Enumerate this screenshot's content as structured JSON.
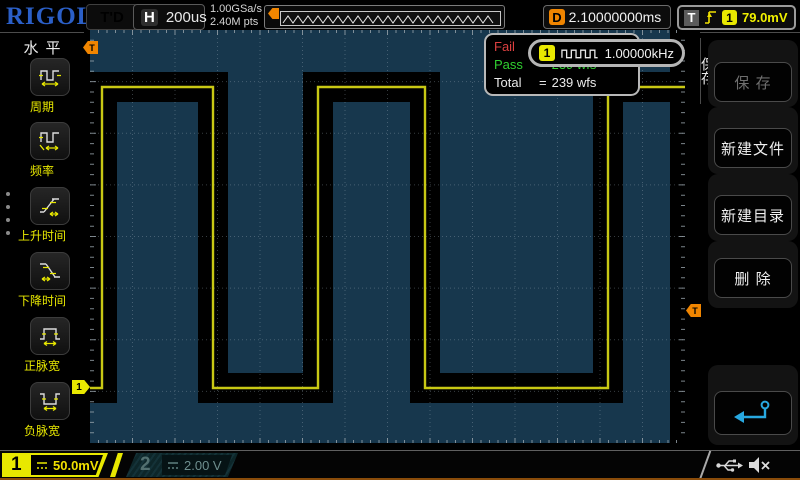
{
  "brand": "RIGOL",
  "top_bar": {
    "trigger_status": "T'D",
    "h_label": "H",
    "timebase": "200us",
    "sample_rate": "1.00GSa/s",
    "memory_depth": "2.40M pts",
    "delay_label": "D",
    "delay_value": "2.10000000ms",
    "trigger_label": "T",
    "trigger_source_channel": "1",
    "trigger_level": "79.0mV"
  },
  "left_menu": {
    "title": "水平",
    "items": [
      {
        "label": "周期",
        "icon": "period-icon"
      },
      {
        "label": "频率",
        "icon": "frequency-icon"
      },
      {
        "label": "上升时间",
        "icon": "rise-time-icon"
      },
      {
        "label": "下降时间",
        "icon": "fall-time-icon"
      },
      {
        "label": "正脉宽",
        "icon": "positive-pulse-width-icon"
      },
      {
        "label": "负脉宽",
        "icon": "negative-pulse-width-icon"
      }
    ]
  },
  "mask_stats": {
    "rows": [
      {
        "label": "Fail",
        "eq": "=",
        "value": ""
      },
      {
        "label": "Pass",
        "eq": "=",
        "value": "239 wfs"
      },
      {
        "label": "Total",
        "eq": "=",
        "value": "239 wfs"
      }
    ]
  },
  "freq_popup": {
    "channel": "1",
    "icon": "square-wave-icon",
    "value": "1.00000kHz"
  },
  "right_menu": {
    "tab": "保存",
    "buttons": [
      {
        "label": "保 存",
        "enabled": false
      },
      {
        "label": "新建文件",
        "enabled": true
      },
      {
        "label": "新建目录",
        "enabled": true
      },
      {
        "label": "删 除",
        "enabled": true
      },
      {
        "label": "",
        "icon": "return-arrow-icon",
        "enabled": true
      }
    ]
  },
  "channels": {
    "ch1": {
      "number": "1",
      "coupling_icon": "dc-coupling-icon",
      "scale": "50.0mV"
    },
    "ch2": {
      "number": "2",
      "coupling_icon": "dc-coupling-icon",
      "scale": "2.00 V"
    }
  },
  "status_icons": {
    "usb": "usb-icon",
    "speaker": "speaker-muted-icon"
  },
  "markers": {
    "trigger_position": "T",
    "trigger_level": "T",
    "channel1": "1"
  },
  "waveform": {
    "type": "square",
    "frequency": "1.00000kHz",
    "grid_width": 595,
    "grid_height": 413,
    "h_divs": 14,
    "v_divs": 8,
    "high_y": 57,
    "low_y": 358,
    "start_level": "low",
    "edges_x": [
      12,
      123,
      228,
      335,
      518
    ],
    "right_mask_column_x": 580
  },
  "colors": {
    "mask_blue": "#17374d",
    "trace_yellow": "#c8c814",
    "channel1_yellow": "#e8e800",
    "channel2_dim": "#527070",
    "trigger_orange": "#f08500",
    "pass_green": "#30d030",
    "fail_red": "#dd4040",
    "logo_blue": "#2b5fc7"
  }
}
